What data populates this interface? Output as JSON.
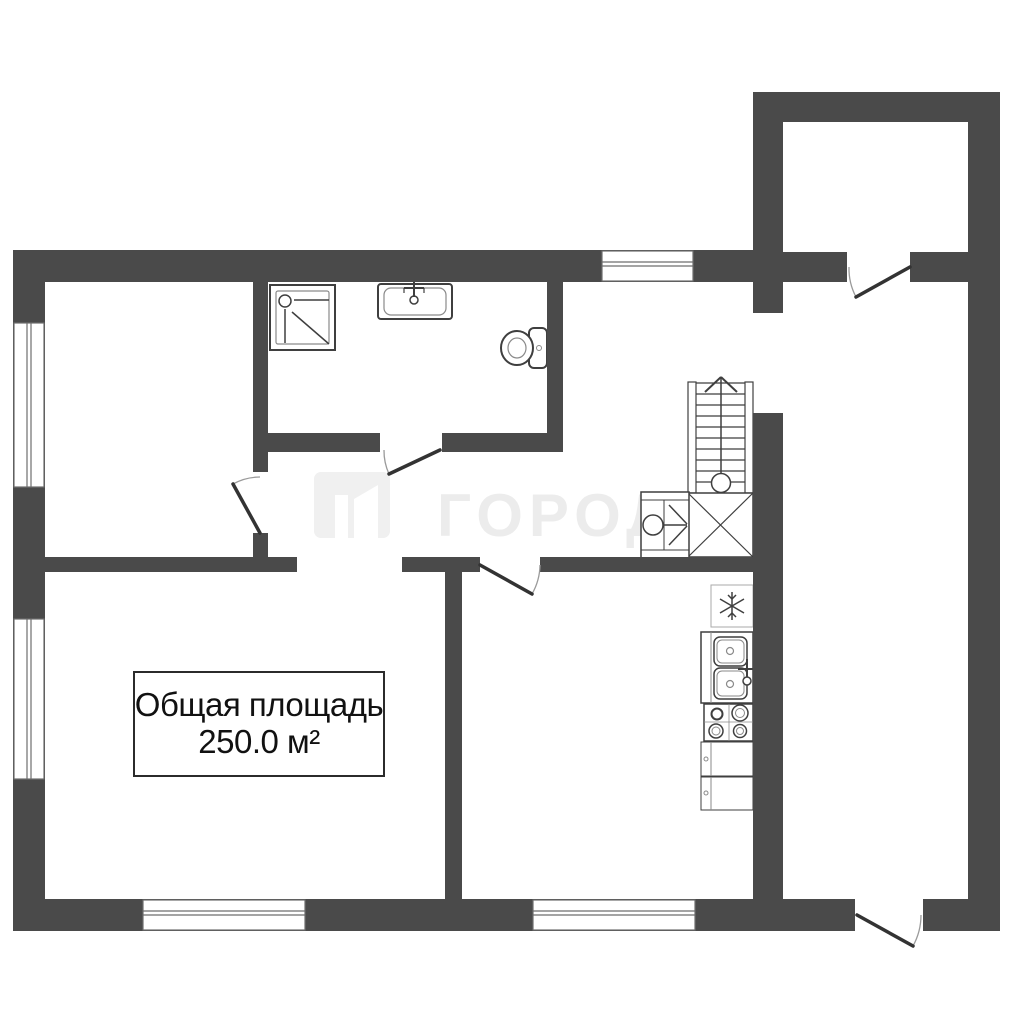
{
  "page": {
    "type": "floor-plan"
  },
  "area_label": {
    "title": "Общая площадь",
    "value": "250.0 м²"
  },
  "watermark": {
    "text": "ГОРОДА",
    "logo": "gorod-logo"
  },
  "fixtures": [
    {
      "name": "shower-tray"
    },
    {
      "name": "washbasin"
    },
    {
      "name": "toilet"
    },
    {
      "name": "staircase-up"
    },
    {
      "name": "understairs-landing"
    },
    {
      "name": "washing-machine"
    },
    {
      "name": "refrigerator"
    },
    {
      "name": "kitchen-double-sink"
    },
    {
      "name": "stove-4-burner"
    },
    {
      "name": "kitchen-cabinets"
    }
  ],
  "openings": {
    "windows_count": 5,
    "doors_count": 5
  },
  "colors": {
    "wall": "#4a4a4a",
    "fixture_line": "#3f3f3f",
    "fixture_line_light": "#8a8a8a",
    "window_frame": "#6e6e6e",
    "door_leaf": "#333333",
    "door_arc": "#9a9a9a",
    "label_text": "#111111",
    "label_border": "#2b2b2b",
    "watermark": "#ececec",
    "watermark_logo": "#f0f0f0",
    "background": "#ffffff"
  }
}
